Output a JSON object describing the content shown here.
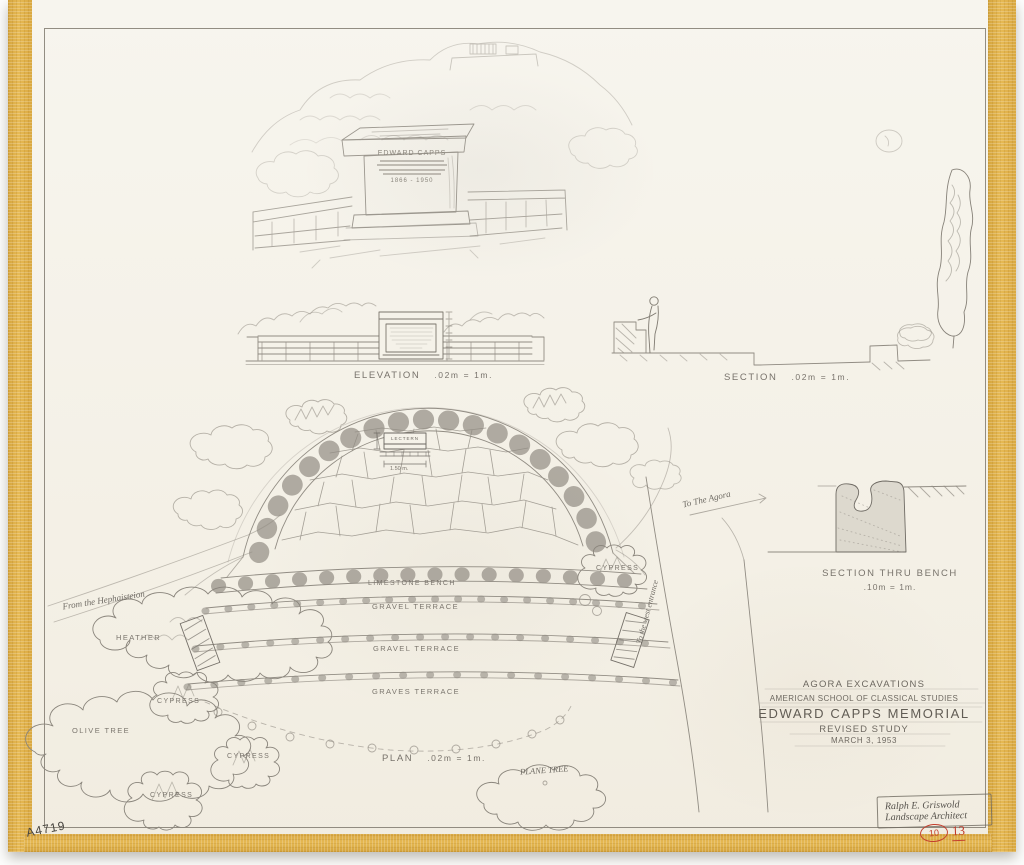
{
  "document": {
    "catalog_number": "A4719",
    "red_marks": {
      "circled": "10",
      "number": "13"
    }
  },
  "perspective": {
    "inscription_title": "EDWARD CAPPS",
    "inscription_dates": "1866 - 1950"
  },
  "drawings": {
    "elevation": {
      "title": "ELEVATION",
      "scale": ".02m = 1m."
    },
    "section": {
      "title": "SECTION",
      "scale": ".02m = 1m."
    },
    "bench_section": {
      "title": "SECTION THRU BENCH",
      "scale": ".10m = 1m."
    },
    "plan": {
      "title": "PLAN",
      "scale": ".02m = 1m."
    }
  },
  "plan_labels": {
    "lectern": "LECTERN",
    "lectern_width": "1.50 m.",
    "rows": [
      "LIMESTONE BENCH",
      "GRAVEL TERRACE",
      "GRAVEL TERRACE",
      "GRAVES TERRACE"
    ],
    "heather": "HEATHER",
    "cypress": "CYPRESS",
    "olive_tree": "OLIVE TREE",
    "plane_tree": "PLANE TREE",
    "from_hephaisteion": "From the Hephaisteion",
    "to_the_agora": "To The Agora",
    "to_west_entrance": "To the west entrance"
  },
  "title_block": {
    "project": "AGORA EXCAVATIONS",
    "institution": "AMERICAN SCHOOL OF CLASSICAL STUDIES",
    "title": "EDWARD CAPPS MEMORIAL",
    "subtitle": "REVISED STUDY",
    "date": "MARCH 3, 1953"
  },
  "signature": {
    "name": "Ralph E. Griswold",
    "role": "Landscape Architect"
  }
}
